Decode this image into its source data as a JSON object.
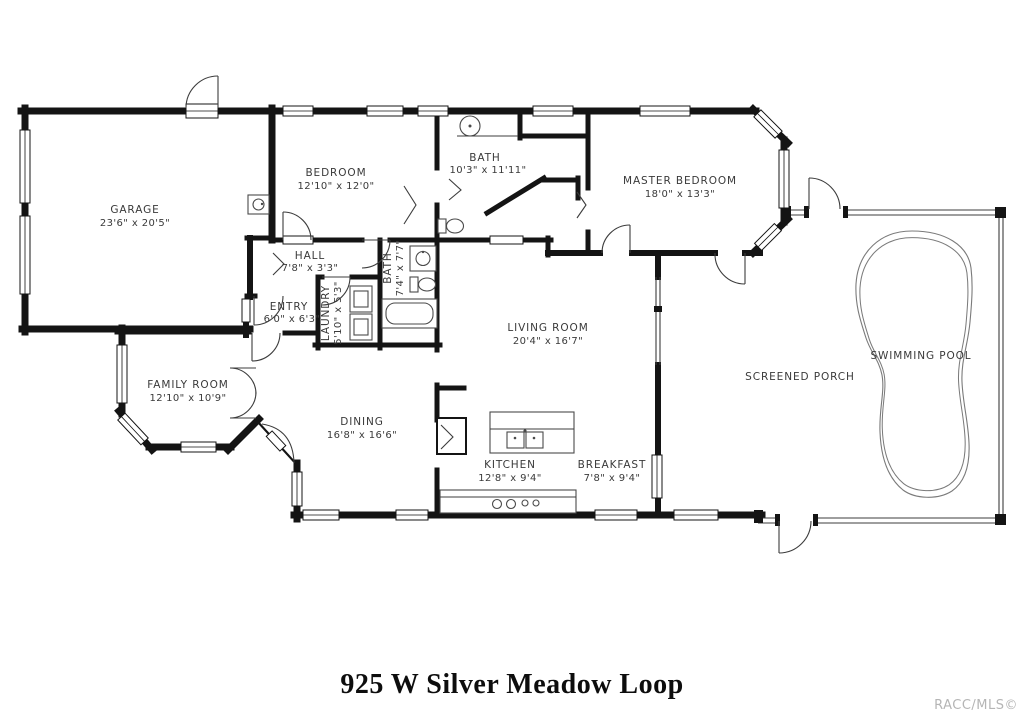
{
  "title": "925 W Silver Meadow Loop",
  "watermark": "RACC/MLS©",
  "colors": {
    "wall": "#141414",
    "label": "#3a3a3a",
    "watermark": "#b5b5b5"
  },
  "rooms": {
    "garage": {
      "name": "GARAGE",
      "dims": "23'6\" x 20'5\""
    },
    "bedroom": {
      "name": "BEDROOM",
      "dims": "12'10\" x 12'0\""
    },
    "bath": {
      "name": "BATH",
      "dims": "10'3\" x 11'11\""
    },
    "master_bedroom": {
      "name": "MASTER BEDROOM",
      "dims": "18'0\" x 13'3\""
    },
    "hall": {
      "name": "HALL",
      "dims": "7'8\" x 3'3\""
    },
    "entry": {
      "name": "ENTRY",
      "dims": "6'0\" x 6'3\""
    },
    "laundry": {
      "name": "LAUNDRY",
      "dims": "5'10\" x 5'3\""
    },
    "bath2": {
      "name": "BATH",
      "dims": "7'4\" x 7'7\""
    },
    "family_room": {
      "name": "FAMILY ROOM",
      "dims": "12'10\" x 10'9\""
    },
    "dining": {
      "name": "DINING",
      "dims": "16'8\" x 16'6\""
    },
    "living_room": {
      "name": "LIVING ROOM",
      "dims": "20'4\" x 16'7\""
    },
    "kitchen": {
      "name": "KITCHEN",
      "dims": "12'8\" x 9'4\""
    },
    "breakfast": {
      "name": "BREAKFAST",
      "dims": "7'8\" x 9'4\""
    },
    "screened_porch": {
      "name": "SCREENED PORCH",
      "dims": ""
    },
    "swimming_pool": {
      "name": "SWIMMING POOL",
      "dims": ""
    }
  }
}
